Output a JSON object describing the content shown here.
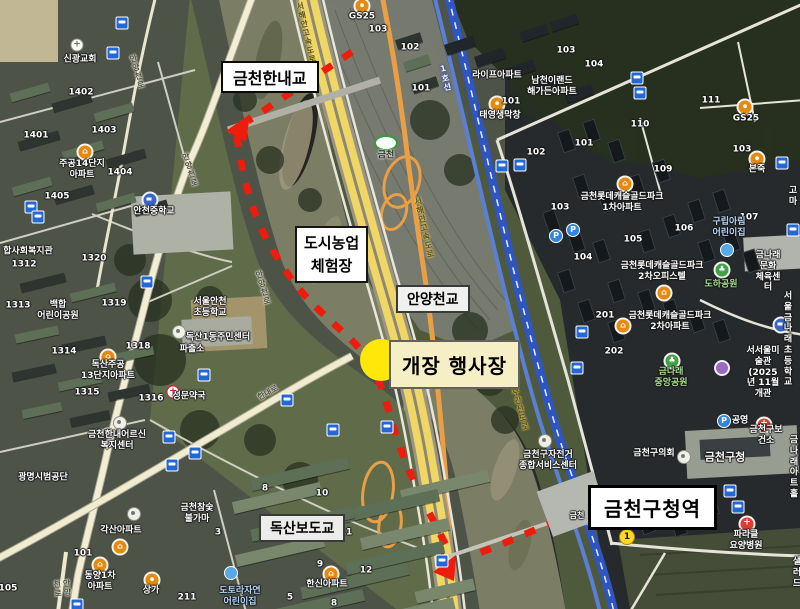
{
  "callouts": {
    "geumcheon_hannae_bridge": {
      "text": "금천한내교"
    },
    "urban_farm": {
      "text": "도시농업\n체험장"
    },
    "anyangcheon_bridge": {
      "text": "안양천교"
    },
    "event_venue": {
      "text": "개장 행사장"
    },
    "doksan_footbridge": {
      "text": "독산보도교"
    },
    "station": {
      "text": "금천구청역"
    }
  },
  "colors": {
    "route_red": "#ed1c0c",
    "event_circle_yellow": "#ffe70a",
    "event_box_bg": "#f6efc5",
    "railway_blue": "#2f55c0",
    "expressway_yellow": "#f0d765",
    "road_orange": "#e89f45"
  },
  "map_labels": [
    {
      "t": "신광교회",
      "x": 80,
      "y": 60
    },
    {
      "t": "1402",
      "x": 81,
      "y": 93
    },
    {
      "t": "1401",
      "x": 36,
      "y": 136
    },
    {
      "t": "1403",
      "x": 104,
      "y": 131
    },
    {
      "t": "주공14단지\n아파트",
      "x": 82,
      "y": 170
    },
    {
      "t": "1404",
      "x": 120,
      "y": 173
    },
    {
      "t": "1405",
      "x": 57,
      "y": 197
    },
    {
      "t": "안천중학교",
      "x": 154,
      "y": 212
    },
    {
      "t": "합사회복지관",
      "x": 28,
      "y": 252
    },
    {
      "t": "1312",
      "x": 24,
      "y": 265
    },
    {
      "t": "1320",
      "x": 94,
      "y": 259
    },
    {
      "t": "1313",
      "x": 18,
      "y": 306
    },
    {
      "t": "백합\n어린이공원",
      "x": 58,
      "y": 311
    },
    {
      "t": "1319",
      "x": 114,
      "y": 304
    },
    {
      "t": "서울안천\n초등학교",
      "x": 210,
      "y": 308
    },
    {
      "t": "독산1동주민센터",
      "x": 218,
      "y": 338
    },
    {
      "t": "파출소",
      "x": 192,
      "y": 350
    },
    {
      "t": "1314",
      "x": 64,
      "y": 352
    },
    {
      "t": "1318",
      "x": 138,
      "y": 347
    },
    {
      "t": "독산주공\n13단지아파트",
      "x": 108,
      "y": 371
    },
    {
      "t": "1315",
      "x": 87,
      "y": 393
    },
    {
      "t": "1316",
      "x": 151,
      "y": 399
    },
    {
      "t": "성문약국",
      "x": 189,
      "y": 397
    },
    {
      "t": "금천한내어르신\n복지센터",
      "x": 117,
      "y": 441
    },
    {
      "t": "광명시범공단",
      "x": 43,
      "y": 478
    },
    {
      "t": "금천참숯\n불가마",
      "x": 197,
      "y": 514
    },
    {
      "t": "각산아파트",
      "x": 121,
      "y": 531
    },
    {
      "t": "101",
      "x": 83,
      "y": 554
    },
    {
      "t": "동양1차\n아파트",
      "x": 100,
      "y": 582
    },
    {
      "t": "상가",
      "x": 151,
      "y": 591
    },
    {
      "t": "105",
      "x": 8,
      "y": 589
    },
    {
      "t": "211",
      "x": 187,
      "y": 598
    },
    {
      "t": "도토라자연\n어린이집",
      "x": 240,
      "y": 597,
      "c": "blue"
    },
    {
      "t": "한신아파트",
      "x": 327,
      "y": 585
    },
    {
      "t": "8",
      "x": 265,
      "y": 489
    },
    {
      "t": "10",
      "x": 322,
      "y": 494
    },
    {
      "t": "3",
      "x": 218,
      "y": 533
    },
    {
      "t": "2",
      "x": 281,
      "y": 531
    },
    {
      "t": "11",
      "x": 346,
      "y": 533
    },
    {
      "t": "9",
      "x": 320,
      "y": 565
    },
    {
      "t": "12",
      "x": 366,
      "y": 571
    },
    {
      "t": "5",
      "x": 290,
      "y": 598
    },
    {
      "t": "8",
      "x": 334,
      "y": 604
    },
    {
      "t": "GS25",
      "x": 362,
      "y": 17
    },
    {
      "t": "103",
      "x": 378,
      "y": 30
    },
    {
      "t": "102",
      "x": 410,
      "y": 48
    },
    {
      "t": "101",
      "x": 421,
      "y": 89
    },
    {
      "t": "라이프아파트",
      "x": 497,
      "y": 76
    },
    {
      "t": "남천이랜드\n해가든아파트",
      "x": 552,
      "y": 87
    },
    {
      "t": "103",
      "x": 566,
      "y": 51
    },
    {
      "t": "104",
      "x": 594,
      "y": 65
    },
    {
      "t": "101",
      "x": 511,
      "y": 102
    },
    {
      "t": "태영생막창",
      "x": 500,
      "y": 116
    },
    {
      "t": "110",
      "x": 640,
      "y": 125
    },
    {
      "t": "111",
      "x": 711,
      "y": 101
    },
    {
      "t": "101",
      "x": 584,
      "y": 144
    },
    {
      "t": "102",
      "x": 536,
      "y": 153
    },
    {
      "t": "109",
      "x": 663,
      "y": 170
    },
    {
      "t": "금천롯데캐슬골드파크\n1차아파트",
      "x": 622,
      "y": 203
    },
    {
      "t": "103",
      "x": 560,
      "y": 208
    },
    {
      "t": "106",
      "x": 684,
      "y": 229
    },
    {
      "t": "107",
      "x": 749,
      "y": 218
    },
    {
      "t": "105",
      "x": 633,
      "y": 240
    },
    {
      "t": "104",
      "x": 583,
      "y": 258
    },
    {
      "t": "103",
      "x": 742,
      "y": 150
    },
    {
      "t": "GS25",
      "x": 746,
      "y": 119
    },
    {
      "t": "본죽",
      "x": 757,
      "y": 170
    },
    {
      "t": "금천롯데캐슬골드파크\n4차오피스텔",
      "x": 806,
      "y": 88
    },
    {
      "t": "고마",
      "x": 793,
      "y": 197
    },
    {
      "t": "구립아림\n어린이집",
      "x": 729,
      "y": 228,
      "c": "blue"
    },
    {
      "t": "금나래문화\n체육센터",
      "x": 768,
      "y": 272
    },
    {
      "t": "도하공원",
      "x": 721,
      "y": 285,
      "c": "green"
    },
    {
      "t": "금천롯데캐슬골드파크\n2차오피스텔",
      "x": 662,
      "y": 272
    },
    {
      "t": "금천롯데캐슬골드파크\n2차아파트",
      "x": 670,
      "y": 322
    },
    {
      "t": "201",
      "x": 605,
      "y": 316
    },
    {
      "t": "202",
      "x": 614,
      "y": 352
    },
    {
      "t": "서울금나래\n초등학교",
      "x": 788,
      "y": 340
    },
    {
      "t": "금나래\n중앙공원",
      "x": 671,
      "y": 378,
      "c": "green"
    },
    {
      "t": "서서울미술관\n(2025년 11월 개관",
      "x": 763,
      "y": 373
    },
    {
      "t": "공영",
      "x": 740,
      "y": 421
    },
    {
      "t": "금천구보건소",
      "x": 766,
      "y": 436
    },
    {
      "t": "금천구의회",
      "x": 654,
      "y": 454
    },
    {
      "t": "금천구청",
      "x": 725,
      "y": 457,
      "s": 11
    },
    {
      "t": "금나래아트홀",
      "x": 794,
      "y": 468
    },
    {
      "t": "금천구자전거\n종합서비스센터",
      "x": 548,
      "y": 461
    },
    {
      "t": "파라클\n요양병원",
      "x": 746,
      "y": 541
    },
    {
      "t": "샐러드",
      "x": 797,
      "y": 573
    },
    {
      "t": "금천",
      "x": 577,
      "y": 516,
      "c": "onrail"
    },
    {
      "t": "금천",
      "x": 386,
      "y": 156,
      "c": "icname"
    },
    {
      "t": "1",
      "x": 627,
      "y": 537,
      "c": "badge"
    },
    {
      "t": "안양천로",
      "x": 137,
      "y": 72,
      "v": 1,
      "r": -16,
      "c": "road"
    },
    {
      "t": "안양천로",
      "x": 190,
      "y": 170,
      "v": 1,
      "r": -18,
      "c": "road"
    },
    {
      "t": "안양천로",
      "x": 263,
      "y": 288,
      "v": 1,
      "r": -16,
      "c": "road"
    },
    {
      "t": "안양천로",
      "x": 62,
      "y": 588,
      "v": 1,
      "r": -6,
      "c": "road"
    },
    {
      "t": "한내로",
      "x": 268,
      "y": 393,
      "r": -29,
      "c": "road"
    },
    {
      "t": "서해안고속도로",
      "x": 306,
      "y": 33,
      "v": 1,
      "r": -13,
      "c": "roadhw"
    },
    {
      "t": "서해안고속도로",
      "x": 424,
      "y": 228,
      "v": 1,
      "r": -13,
      "c": "roadhw"
    },
    {
      "t": "서부간선도로",
      "x": 519,
      "y": 405,
      "v": 1,
      "r": -15,
      "c": "roadhw"
    },
    {
      "t": "1호선",
      "x": 445,
      "y": 78,
      "v": 1,
      "r": -13,
      "c": "rail"
    }
  ],
  "markers": [
    {
      "k": "church",
      "x": 77,
      "y": 45
    },
    {
      "k": "bus",
      "x": 122,
      "y": 23
    },
    {
      "k": "bus",
      "x": 113,
      "y": 53
    },
    {
      "k": "apt",
      "x": 85,
      "y": 152
    },
    {
      "k": "school",
      "x": 150,
      "y": 200
    },
    {
      "k": "bus",
      "x": 31,
      "y": 207
    },
    {
      "k": "bus",
      "x": 38,
      "y": 217
    },
    {
      "k": "bus",
      "x": 147,
      "y": 282
    },
    {
      "k": "office",
      "x": 179,
      "y": 332
    },
    {
      "k": "apt",
      "x": 108,
      "y": 357
    },
    {
      "k": "bus",
      "x": 204,
      "y": 375
    },
    {
      "k": "pharm",
      "x": 173,
      "y": 392
    },
    {
      "k": "bus",
      "x": 287,
      "y": 400
    },
    {
      "k": "office",
      "x": 120,
      "y": 423
    },
    {
      "k": "bus",
      "x": 169,
      "y": 437
    },
    {
      "k": "bus",
      "x": 195,
      "y": 453
    },
    {
      "k": "bus",
      "x": 172,
      "y": 465
    },
    {
      "k": "bus",
      "x": 333,
      "y": 430
    },
    {
      "k": "bus",
      "x": 387,
      "y": 427
    },
    {
      "k": "office",
      "x": 134,
      "y": 514
    },
    {
      "k": "apt",
      "x": 120,
      "y": 547
    },
    {
      "k": "apt",
      "x": 100,
      "y": 565
    },
    {
      "k": "shop",
      "x": 152,
      "y": 580
    },
    {
      "k": "apt",
      "x": 331,
      "y": 574
    },
    {
      "k": "daycare",
      "x": 231,
      "y": 573
    },
    {
      "k": "bus",
      "x": 77,
      "y": 605
    },
    {
      "k": "shop",
      "x": 362,
      "y": 6
    },
    {
      "k": "ic",
      "x": 386,
      "y": 143
    },
    {
      "k": "shop",
      "x": 497,
      "y": 104
    },
    {
      "k": "bus",
      "x": 502,
      "y": 166
    },
    {
      "k": "bus",
      "x": 520,
      "y": 165
    },
    {
      "k": "parking",
      "x": 556,
      "y": 236
    },
    {
      "k": "parking",
      "x": 573,
      "y": 230
    },
    {
      "k": "bus",
      "x": 637,
      "y": 78
    },
    {
      "k": "bus",
      "x": 640,
      "y": 93
    },
    {
      "k": "apt",
      "x": 625,
      "y": 184
    },
    {
      "k": "shop",
      "x": 745,
      "y": 107
    },
    {
      "k": "shop",
      "x": 757,
      "y": 159
    },
    {
      "k": "bus",
      "x": 782,
      "y": 163
    },
    {
      "k": "apt",
      "x": 664,
      "y": 293
    },
    {
      "k": "apt",
      "x": 623,
      "y": 326
    },
    {
      "k": "daycare",
      "x": 727,
      "y": 250
    },
    {
      "k": "park",
      "x": 722,
      "y": 270
    },
    {
      "k": "bus",
      "x": 793,
      "y": 230
    },
    {
      "k": "school",
      "x": 781,
      "y": 325
    },
    {
      "k": "park",
      "x": 672,
      "y": 361
    },
    {
      "k": "museum",
      "x": 722,
      "y": 368
    },
    {
      "k": "parking",
      "x": 724,
      "y": 421
    },
    {
      "k": "hospital",
      "x": 764,
      "y": 425
    },
    {
      "k": "office",
      "x": 684,
      "y": 457
    },
    {
      "k": "office",
      "x": 545,
      "y": 441
    },
    {
      "k": "bus",
      "x": 582,
      "y": 332
    },
    {
      "k": "bus",
      "x": 577,
      "y": 368
    },
    {
      "k": "bus",
      "x": 730,
      "y": 491
    },
    {
      "k": "bus",
      "x": 738,
      "y": 507
    },
    {
      "k": "hospital",
      "x": 747,
      "y": 524
    },
    {
      "k": "bus",
      "x": 442,
      "y": 561
    }
  ]
}
